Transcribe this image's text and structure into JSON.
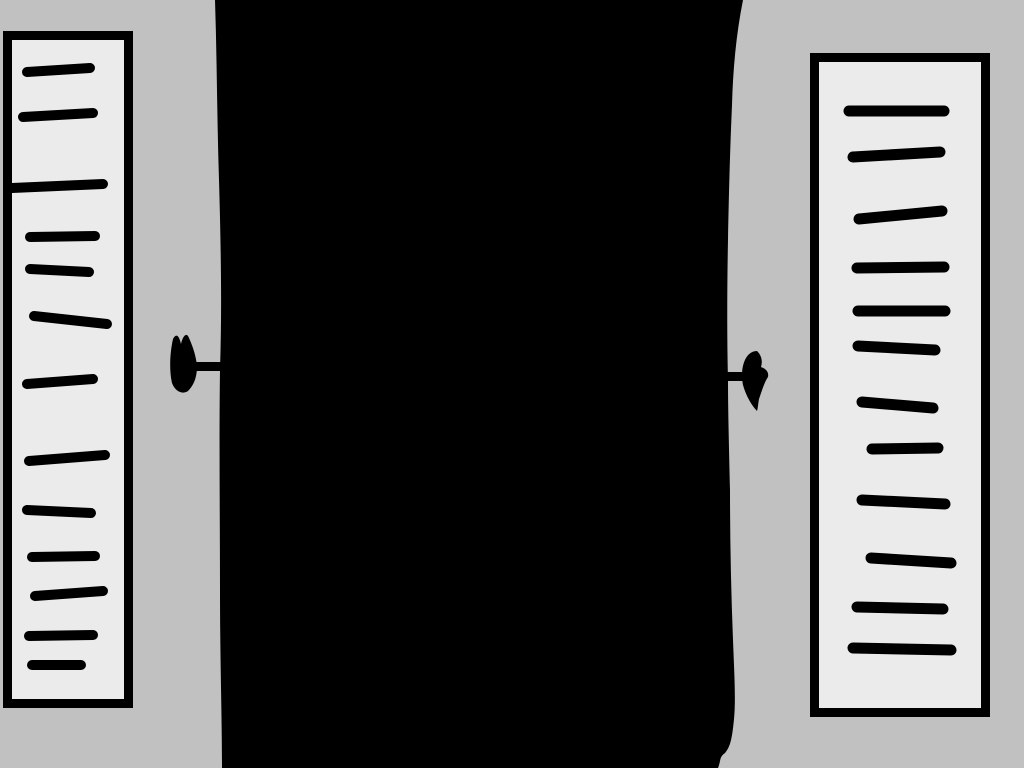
{
  "canvas": {
    "width": 1024,
    "height": 768
  },
  "colors": {
    "background": "#c1c1c1",
    "panel_fill": "#ebebeb",
    "ink": "#000000"
  },
  "center_blob": {
    "path": "M215,0 C217,60 217,120 219,180 C221,250 222,310 220,370 C219,440 220,520 220,590 C220,660 222,715 222,768 L718,768 C721,761 719,757 725,753 C730,747 732,740 734,719 C736,699 734,668 733,640 C731,590 730,540 730,490 C729,445 728,410 728,380 C727,340 727,290 728,240 C729,190 730,150 732,105 C733,70 736,35 743,0 Z"
  },
  "left_arrow": {
    "stem": [
      193,
      362,
      31,
      9
    ],
    "head": "M173,339 C176,333 179,335 181,344 C183,335 187,332 189,338 C193,347 196,356 197,366 C197,377 194,385 188,391 C182,395 175,391 172,383 C169,370 170,352 173,339 Z"
  },
  "right_arrow": {
    "stem": [
      724,
      372,
      27,
      9
    ],
    "head": "M757,351 C761,355 763,360 761,367 C766,369 769,372 768,377 C765,381 762,390 759,399 C758,404 758,408 757,411 C752,406 746,396 743,385 C741,375 742,365 746,358 C749,353 753,351 757,351 Z"
  },
  "left_panel": {
    "outer": {
      "x": 3,
      "y": 31,
      "width": 130,
      "height": 677
    },
    "border": 9,
    "line_width": 10,
    "lines": [
      [
        27,
        72,
        90,
        68
      ],
      [
        23,
        117,
        93,
        113
      ],
      [
        12,
        188,
        103,
        184
      ],
      [
        30,
        237,
        95,
        236
      ],
      [
        30,
        269,
        89,
        272
      ],
      [
        34,
        316,
        107,
        324
      ],
      [
        27,
        384,
        93,
        379
      ],
      [
        29,
        461,
        105,
        455
      ],
      [
        27,
        510,
        91,
        513
      ],
      [
        32,
        557,
        95,
        556
      ],
      [
        35,
        596,
        103,
        591
      ],
      [
        29,
        636,
        93,
        635
      ],
      [
        32,
        665,
        81,
        665
      ]
    ]
  },
  "right_panel": {
    "outer": {
      "x": 810,
      "y": 53,
      "width": 180,
      "height": 664
    },
    "border": 9,
    "line_width": 11,
    "lines": [
      [
        849,
        111,
        944,
        111
      ],
      [
        853,
        157,
        940,
        152
      ],
      [
        859,
        219,
        942,
        211
      ],
      [
        857,
        268,
        944,
        267
      ],
      [
        858,
        311,
        945,
        311
      ],
      [
        858,
        346,
        935,
        350
      ],
      [
        862,
        402,
        933,
        408
      ],
      [
        872,
        449,
        938,
        448
      ],
      [
        862,
        500,
        945,
        504
      ],
      [
        871,
        558,
        951,
        563
      ],
      [
        857,
        607,
        943,
        609
      ],
      [
        853,
        648,
        951,
        650
      ]
    ]
  }
}
